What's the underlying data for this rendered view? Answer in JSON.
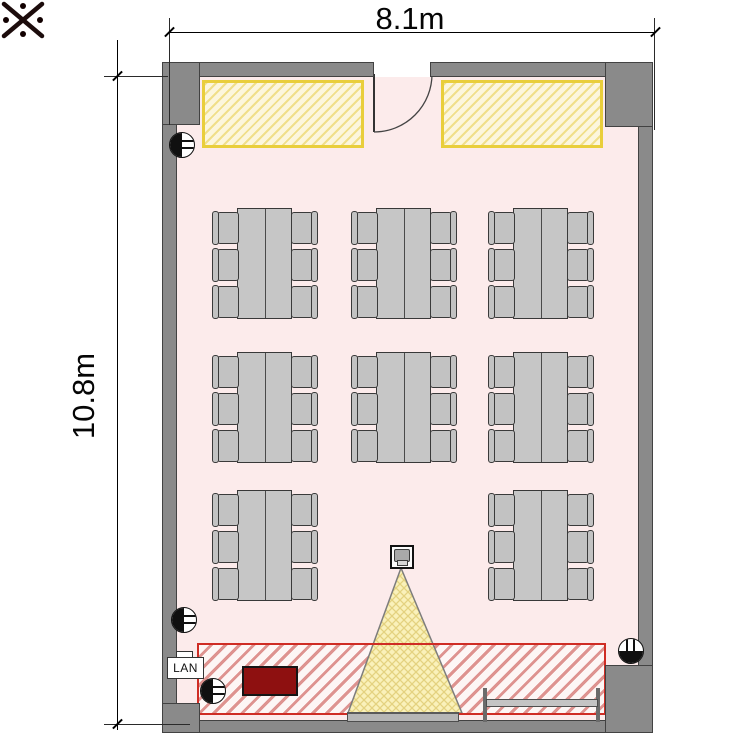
{
  "plan": {
    "title": "classroom-floor-plan",
    "width_label": "8.1m",
    "height_label": "10.8m",
    "lan_label": "LAN",
    "room_width_m": 8.1,
    "room_height_m": 10.8
  },
  "colors": {
    "wall": "#8a8a8a",
    "floor": "#fcebeb",
    "storage_border": "#e9ce3b",
    "zone_border": "#cf2c24",
    "podium": "#8e1010",
    "beam_fill": "#faf1ba",
    "furniture": "#c6c6c6"
  },
  "furniture": {
    "table_groups": [
      {
        "x": 216,
        "y": 208
      },
      {
        "x": 355,
        "y": 208
      },
      {
        "x": 492,
        "y": 208
      },
      {
        "x": 216,
        "y": 352
      },
      {
        "x": 355,
        "y": 352
      },
      {
        "x": 492,
        "y": 352
      },
      {
        "x": 216,
        "y": 490
      },
      {
        "x": 492,
        "y": 490
      }
    ],
    "chairs_per_group": 6,
    "total_seats": 48
  },
  "outlets": [
    {
      "x": 182,
      "y": 145,
      "rot": 0
    },
    {
      "x": 184,
      "y": 620,
      "rot": 0
    },
    {
      "x": 213,
      "y": 691,
      "rot": 0
    },
    {
      "x": 631,
      "y": 651,
      "rot": -90
    }
  ],
  "equipment": {
    "projector": "ceiling-projector",
    "screen": "projection-screen",
    "whiteboard": "wall-whiteboard",
    "podium": "presenter-desk",
    "lan_port": "lan-wall-port",
    "reference_mark": "reference-mark"
  }
}
